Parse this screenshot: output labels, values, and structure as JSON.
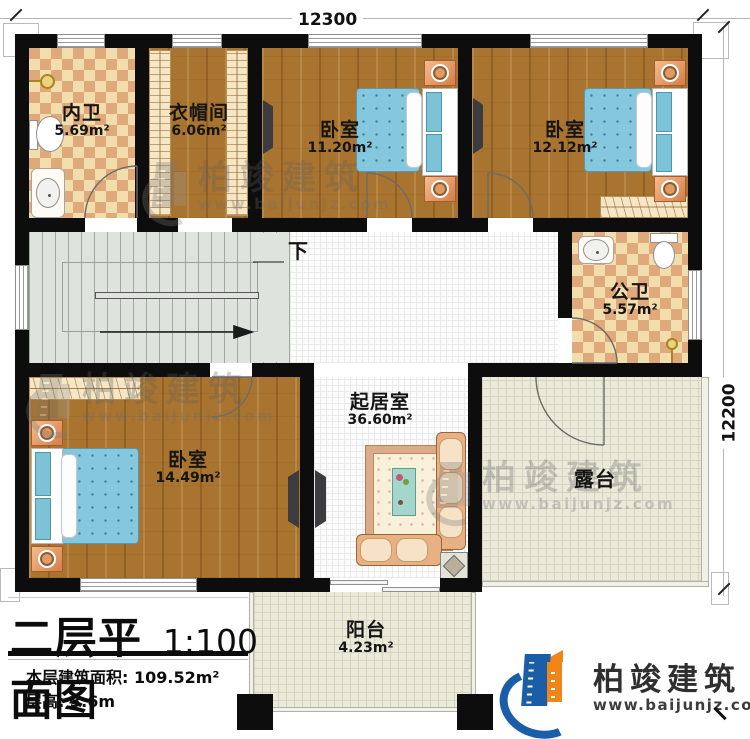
{
  "dimensions": {
    "top": "12300",
    "right": "12200"
  },
  "rooms": {
    "neiwei": {
      "name": "内卫",
      "area": "5.69m²"
    },
    "cloakroom": {
      "name": "衣帽间",
      "area": "6.06m²"
    },
    "bedroom1": {
      "name": "卧室",
      "area": "11.20m²"
    },
    "bedroom2": {
      "name": "卧室",
      "area": "12.12m²"
    },
    "gongwei": {
      "name": "公卫",
      "area": "5.57m²"
    },
    "living": {
      "name": "起居室",
      "area": "36.60m²"
    },
    "bedroom3": {
      "name": "卧室",
      "area": "14.49m²"
    },
    "terrace": {
      "name": "露台"
    },
    "balcony": {
      "name": "阳台",
      "area": "4.23m²"
    }
  },
  "stairs": {
    "direction_label": "下"
  },
  "title_block": {
    "title": "二层平面图",
    "scale": "1:100",
    "area_label": "本层建筑面积:",
    "area_value": "109.52m²",
    "floor_height_label": "层高:",
    "floor_height_value": "3.6m"
  },
  "brand": {
    "name": "柏竣建筑",
    "website": "www.baijunjz.com"
  },
  "watermark": {
    "name": "柏竣建筑",
    "website": "www.baijunjz.com"
  },
  "icons": {
    "stair_direction_arrow": "arrow-right",
    "logo_building": "building-swoosh"
  },
  "colors": {
    "wall": "#0d0d0d",
    "wood_floor": "#a9742f",
    "tile_light": "#f2ddac",
    "tile_dark": "#e0a97b",
    "living_floor": "#fcfcfc",
    "terrace_floor": "#eaeadb",
    "stairs_floor": "#dee4dd",
    "bed": "#85c7dc",
    "sofa": "#e7b183",
    "logo_blue": "#1b5ea8",
    "logo_orange": "#f08519"
  }
}
